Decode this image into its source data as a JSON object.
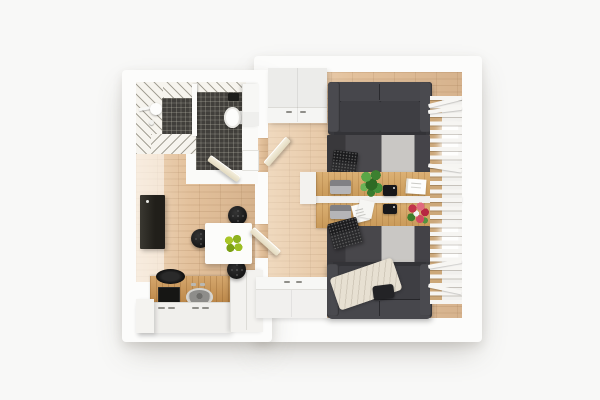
{
  "scene": {
    "type": "architectural-3d-render",
    "view": "top-down floor plan",
    "subject": "small apartment interior render on white background",
    "background_color": "#f8f8f7"
  },
  "palette": {
    "wall": "#fcfcfb",
    "floor_wood": "#e3c19c",
    "desk_wood": "#d3a15d",
    "counter_wood": "#c78f4c",
    "bathroom_tile": "#413f3b",
    "stripe_wall_base": "#f6f4ee",
    "stripe_wall_line": "#8e8b80",
    "sofa_charcoal": "#3c3c40",
    "rug_dark": "#48474b",
    "rug_light": "#c9c7c4",
    "blanket_cream": "#e7e0d2",
    "door_cream": "#efe7d3",
    "cabinet_white": "#f1f0ee",
    "fridge_black": "#26241f",
    "chair_black": "#1c1c1c",
    "apple_green": "#9cbe24",
    "plant_green": "#49913a",
    "flower_red": "#c2334a",
    "laptop_silver": "#b5b5b8",
    "laptop_black": "#1d1d1f",
    "sink_gray": "#8e8d8a",
    "curtain_slat": "#f6f5f2"
  },
  "rooms": {
    "bathroom": {
      "position": "top-left",
      "items": [
        "dark tiled floor",
        "striped tile walls",
        "shower fixture",
        "toilet",
        "white vanity cabinet",
        "washer outline",
        "black accessory box",
        "open cream door"
      ]
    },
    "kitchen_dining": {
      "position": "bottom-left",
      "items": [
        "wood floor",
        "tall black fridge",
        "wood countertop",
        "black cooktop",
        "black pan",
        "round gray sink",
        "white base cabinets",
        "white tall unit",
        "white dining table",
        "bowl of 4 green apples",
        "3 black round chairs"
      ]
    },
    "hallway": {
      "position": "center",
      "items": [
        "wood floor",
        "2 open cream doors in dividing wall"
      ]
    },
    "living_room_office": {
      "position": "right",
      "items": [
        "wood floor",
        "white wardrobe with 2 handles",
        "charcoal sofa top",
        "charcoal sofa bottom with cream blanket and black pillow",
        "2 two-tone area rugs",
        "2 black laptops on rugs",
        "double wooden desk with white divider",
        "2 silver laptops",
        "2 black tablets",
        "potted green plant",
        "white memo board",
        "scattered papers",
        "red flower bouquet",
        "white sideboard cabinets",
        "slatted white window curtains with 2 bright glass panes"
      ]
    }
  }
}
